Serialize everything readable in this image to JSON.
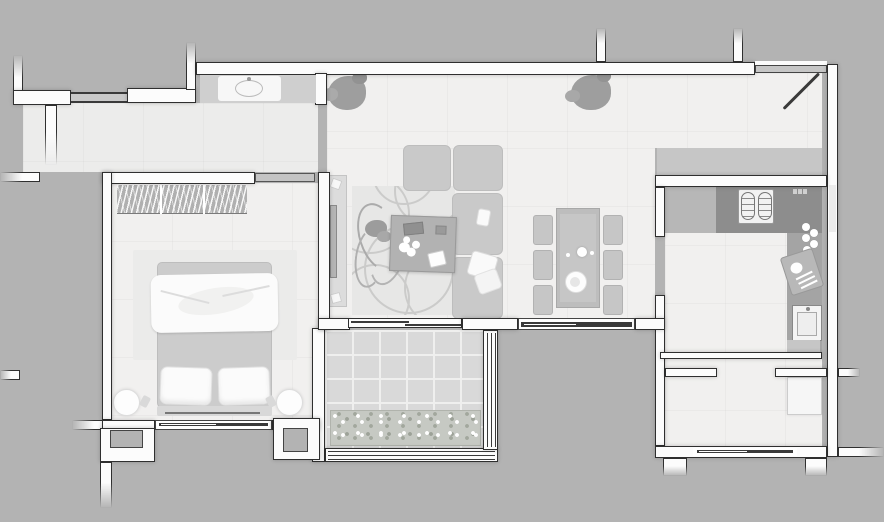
{
  "meta": {
    "type": "architectural floor plan",
    "view": "top-down rendered plan",
    "style": "grayscale render on gray background",
    "title": "One-bedroom apartment floor plan"
  },
  "palette": {
    "bg": "#b3b3b3",
    "floor": "#f1f0ef",
    "floor2": "#ececeb",
    "wall": "#fcfcfc",
    "wline": "#2f2f2f",
    "closet": "#c6c6c6",
    "sideboard": "#cfcfcf",
    "cdark": "#8d8d8d",
    "cmid": "#b7b7b7",
    "cside": "#a4a4a4",
    "sofa": "#c9c9c9",
    "cushionline": "#bdbdbd",
    "table": "#bdbdbd",
    "tableinner": "#c6c6c6",
    "chair": "#c6c6c6",
    "ctable": "#b2b2b2",
    "rug": "#e7e7e6",
    "swirl": "#cbcbca",
    "brug": "#ebebea",
    "tile": "#d9d9d9",
    "grout": "#efefee",
    "planter": "#c6c9c3",
    "plant": "#9e9e9e",
    "tv": "#b5b5b5",
    "console": "#dcdcdc",
    "mattress": "#cccccc",
    "white": "#fbfbfb",
    "wardrobe": "#b0b0b0",
    "win": "#3a3a3a",
    "door": "#c6c6c6",
    "pocket": "#c4c4c4"
  },
  "rooms": [
    {
      "id": "entry-hall",
      "label": "Entry hall",
      "features": [
        "console sideboard",
        "wash basin",
        "window in top-left wall"
      ]
    },
    {
      "id": "living-room",
      "label": "Living room",
      "features": [
        "L-shaped sofa",
        "coffee table with flower bouquet and books",
        "TV console with TV",
        "patterned area rug",
        "large floor plant",
        "two potted plants by top wall"
      ]
    },
    {
      "id": "dining-area",
      "label": "Dining area",
      "features": [
        "rectangular dining table",
        "six chairs",
        "centerpiece flowers",
        "fruit plate",
        "window below"
      ]
    },
    {
      "id": "kitchen",
      "label": "Kitchen",
      "features": [
        "L-shaped counter",
        "two-burner cooktop",
        "sink",
        "cutting board with food",
        "jars"
      ]
    },
    {
      "id": "bedroom",
      "label": "Bedroom",
      "features": [
        "double bed with twisted white duvet",
        "two pillows",
        "two round nightstands",
        "striped wardrobe",
        "rug",
        "window below bed"
      ]
    },
    {
      "id": "balcony",
      "label": "Balcony",
      "features": [
        "tiled floor",
        "flower planter box",
        "triple-line railing"
      ]
    },
    {
      "id": "utility-room",
      "label": "Utility room",
      "features": [
        "washer / shower tray",
        "window",
        "doorway from kitchen"
      ]
    },
    {
      "id": "entrance",
      "label": "Entrance",
      "features": [
        "door leaf open at 45 degrees",
        "gray threshold header"
      ]
    }
  ],
  "counts": {
    "dining_chairs": 6,
    "cooktop_burners": 2,
    "bed_pillows": 2,
    "nightstands": 2,
    "potted_plants_top": 2,
    "jars_on_counter": 5,
    "balcony_railing_lines": 3
  }
}
